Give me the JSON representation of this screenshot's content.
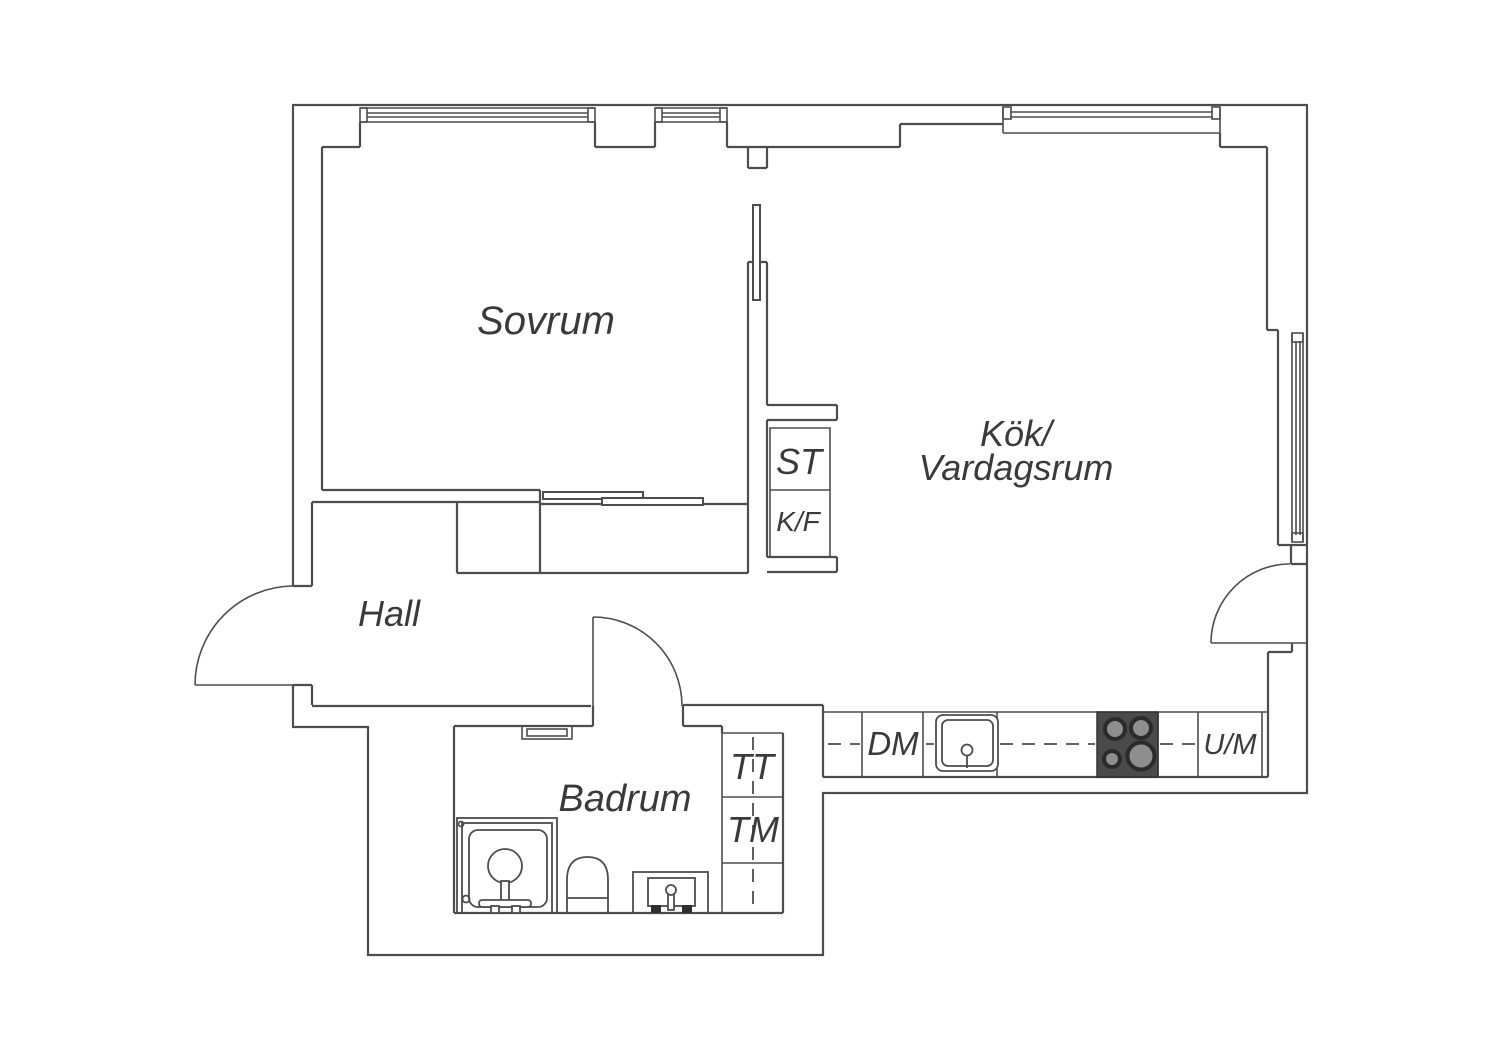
{
  "title": "Apartment floor plan",
  "colors": {
    "background": "#ffffff",
    "line": "#4d4d4d",
    "label_text": "#3a3a3a",
    "stove_body": "#4a4a4a",
    "burner_center": "#8e8e8e"
  },
  "labels": {
    "bedroom": "Sovrum",
    "kitchen_living_line1": "Kök/",
    "kitchen_living_line2": "Vardagsrum",
    "hall": "Hall",
    "bathroom": "Badrum",
    "cleaning_closet": "ST",
    "fridge_freezer": "K/F",
    "tumble_dryer": "TT",
    "washing_machine": "TM",
    "dishwasher": "DM",
    "oven_microwave": "U/M"
  }
}
